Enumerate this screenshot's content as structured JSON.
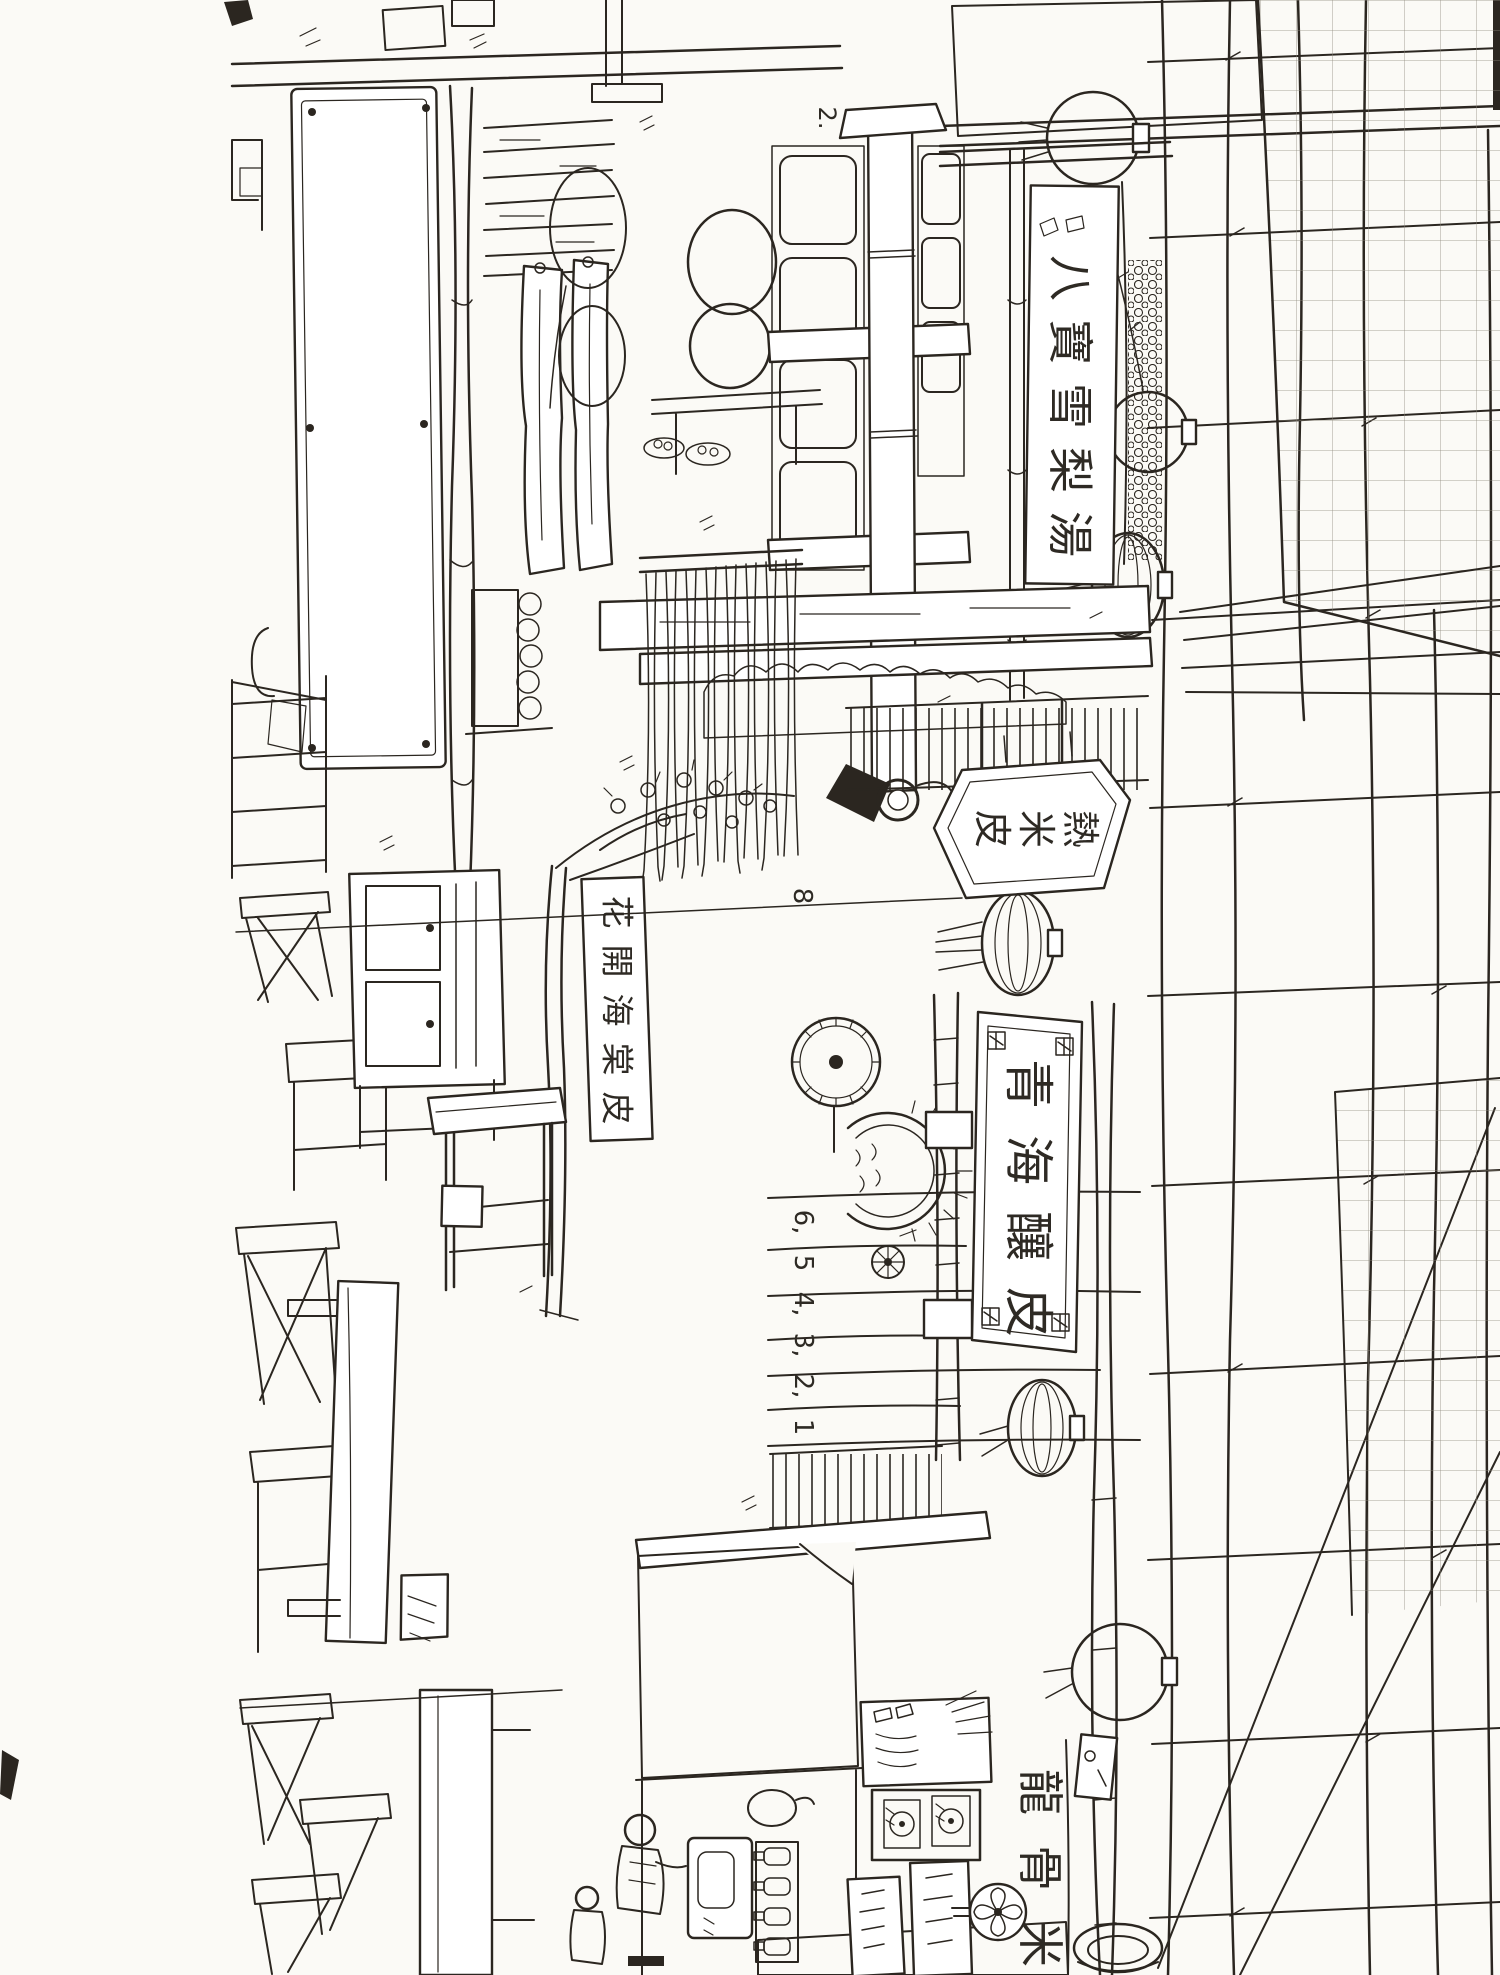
{
  "artwork": {
    "description": "pen-and-ink street market sketch, drawn in landscape and rotated 90 degrees clockwise on the page",
    "palette": {
      "paper": "#fbfaf6",
      "ink": "#2b2620"
    },
    "signs": {
      "top_banner": "八寶雪梨湯",
      "hanging_plaque": "熱米皮",
      "large_banner": "青海釀皮",
      "blossom_sign": "花開海棠皮",
      "bottom_sign": "龍骨米"
    },
    "annotations": {
      "beam_number": [
        "2."
      ],
      "curtain_number": [
        "8"
      ],
      "plank_numbers": [
        "6,",
        "5",
        "4,",
        "3,",
        "2,",
        "1"
      ]
    }
  }
}
